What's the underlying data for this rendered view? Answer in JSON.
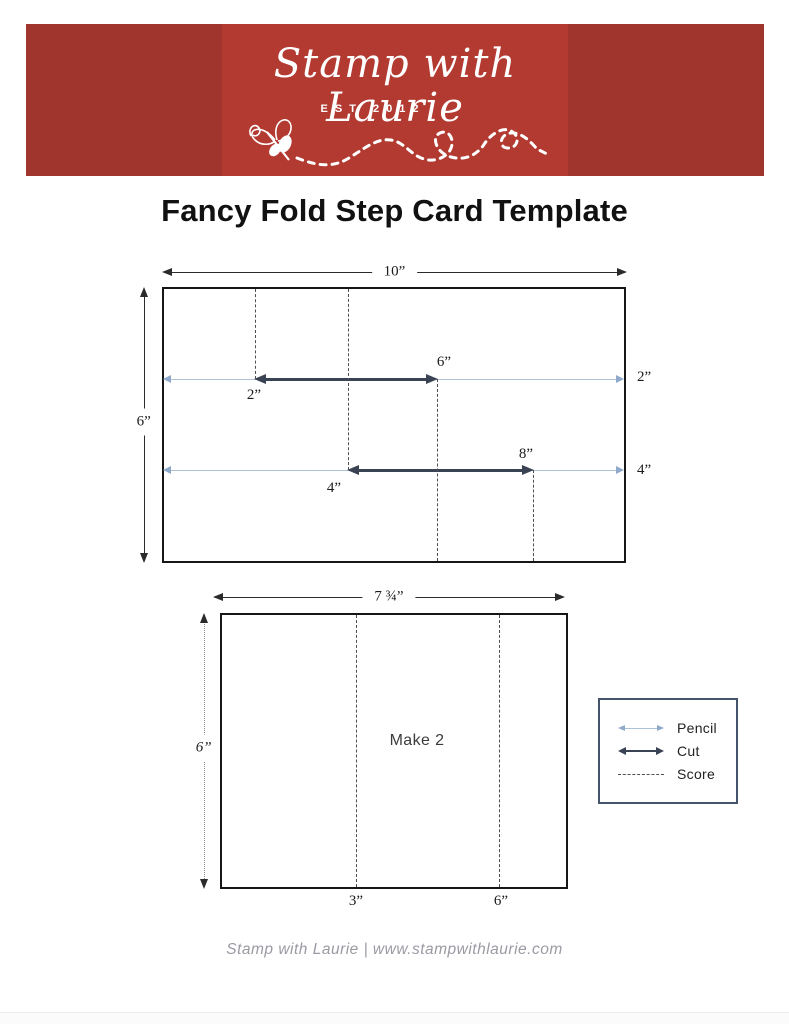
{
  "page": {
    "title": "Fancy Fold Step Card Template",
    "footer_text": "Stamp with Laurie | www.stampwithlaurie.com"
  },
  "header": {
    "brand_name": "Stamp with Laurie",
    "established": "EST 2012"
  },
  "colors": {
    "red-outer": "#A0352E",
    "red-inner": "#B23A31",
    "pencil": "#AEC2DA",
    "pencil-head": "#8FA9CB",
    "cut": "#3A4354",
    "score": "#4F4F4F",
    "dim": "#2B2B2B",
    "legend-border": "#44546A",
    "footer-gray": "#9C99A3",
    "ink": "#111111"
  },
  "diagram1": {
    "width_label": "10”",
    "height_label": "6”",
    "pencil1_right_label": "2”",
    "pencil2_right_label": "4”",
    "cut1_left_label": "2”",
    "cut1_right_label": "6”",
    "cut2_left_label": "4”",
    "cut2_right_label": "8”"
  },
  "diagram2": {
    "width_label": "7 ¾”",
    "height_label": "6”",
    "note": "Make 2",
    "score1_label": "3”",
    "score2_label": "6”"
  },
  "legend": {
    "items": [
      {
        "name": "pencil",
        "label": "Pencil"
      },
      {
        "name": "cut",
        "label": "Cut"
      },
      {
        "name": "score",
        "label": "Score"
      }
    ]
  }
}
